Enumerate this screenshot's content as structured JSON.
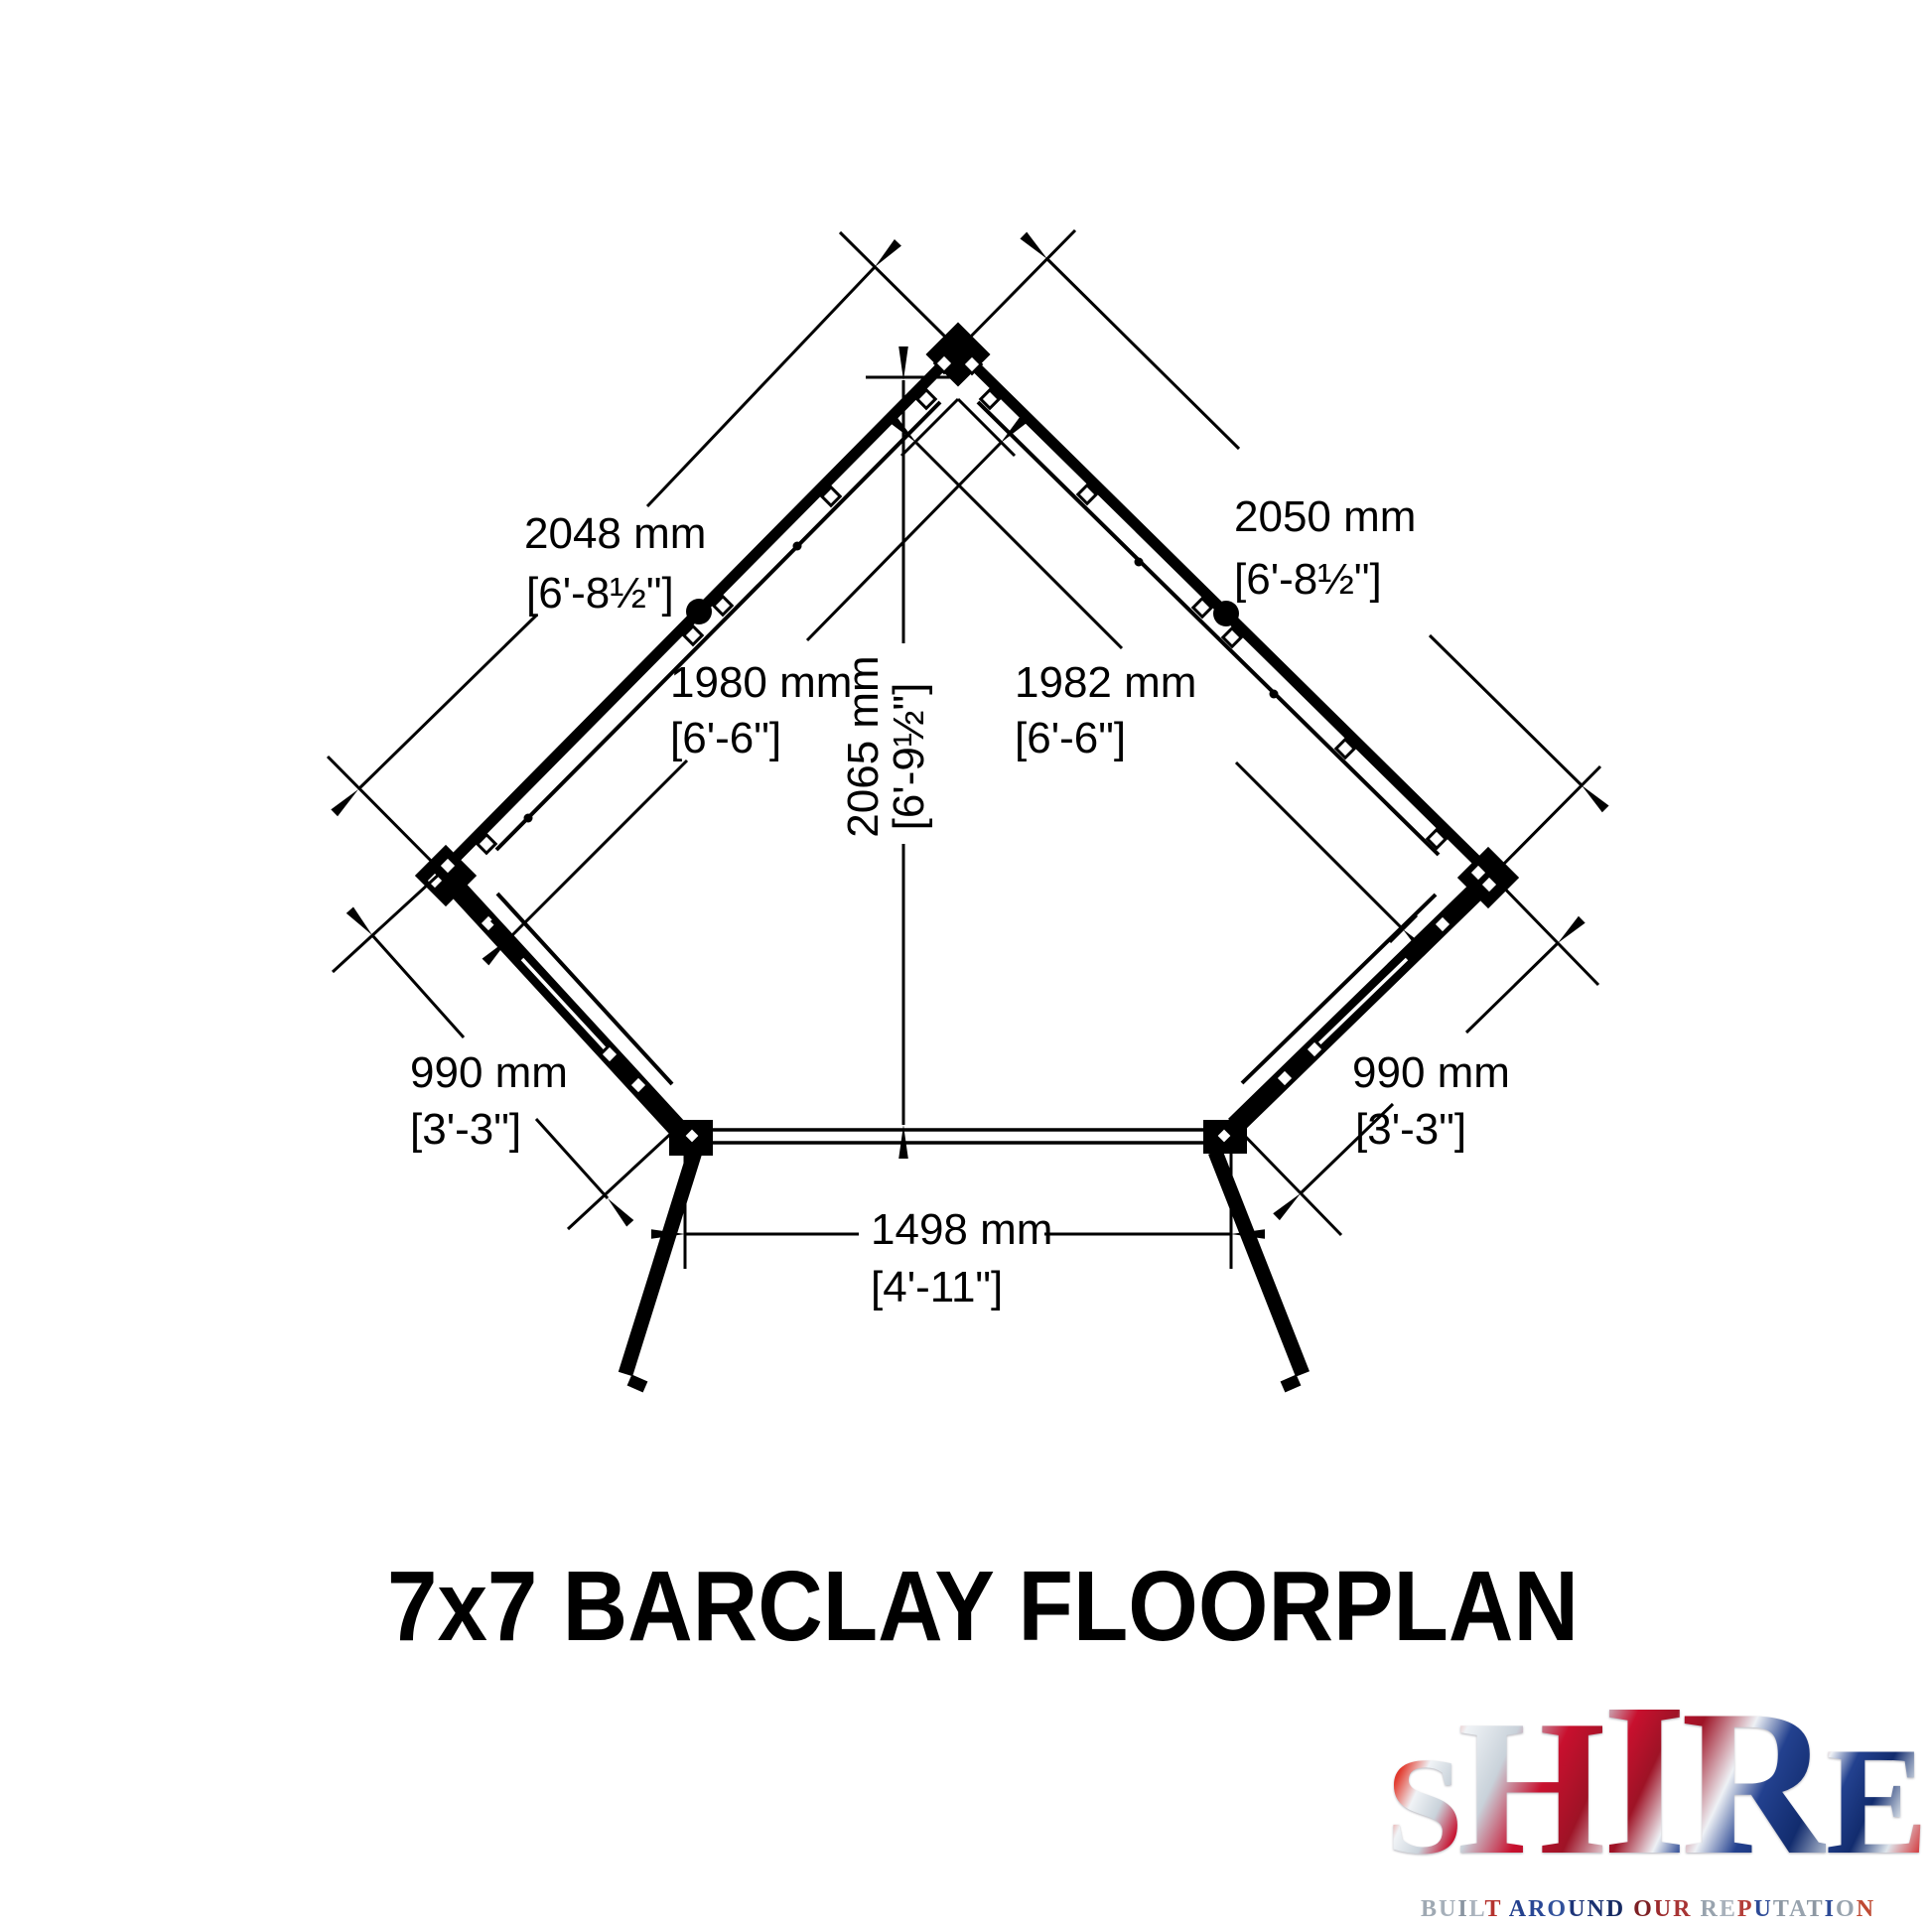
{
  "title": "7x7 BARCLAY FLOORPLAN",
  "drawing": {
    "dimensions": {
      "upper_left_outer": {
        "mm": "2048 mm",
        "ftin": "[6'-8½\"]"
      },
      "upper_right_outer": {
        "mm": "2050 mm",
        "ftin": "[6'-8½\"]"
      },
      "upper_left_inner": {
        "mm": "1980 mm",
        "ftin": "[6'-6\"]"
      },
      "upper_right_inner": {
        "mm": "1982 mm",
        "ftin": "[6'-6\"]"
      },
      "center_height": {
        "mm": "2065 mm",
        "ftin": "[6'-9½\"]"
      },
      "lower_left_wall": {
        "mm": "990 mm",
        "ftin": "[3'-3\"]"
      },
      "lower_right_wall": {
        "mm": "990 mm",
        "ftin": "[3'-3\"]"
      },
      "front_opening": {
        "mm": "1498 mm",
        "ftin": "[4'-11\"]"
      }
    }
  },
  "logo": {
    "word": "SHIRE",
    "tagline": "BUILT AROUND OUR REPUTATION",
    "flag_colors": {
      "red": "#c8102e",
      "blue": "#1c3a85",
      "silver": "#c7d0d9"
    },
    "tagline_letter_colors": [
      "#9fa9b3",
      "#a6b0ba",
      "#8a95a1",
      "#aab3bd",
      "#b5332e",
      null,
      "#24418e",
      "#2a4896",
      "#31519b",
      "#1d3579",
      "#1a3170",
      "#162a62",
      null,
      "#7d2024",
      "#9c2a2c",
      "#a83434",
      null,
      "#98a3ae",
      "#a8b1bb",
      "#b4403a",
      "#2c4a96",
      "#8d98a3",
      "#98a3ae",
      "#8d98a3",
      "#2c4a96",
      "#98a3ae",
      "#bf4a33"
    ]
  }
}
